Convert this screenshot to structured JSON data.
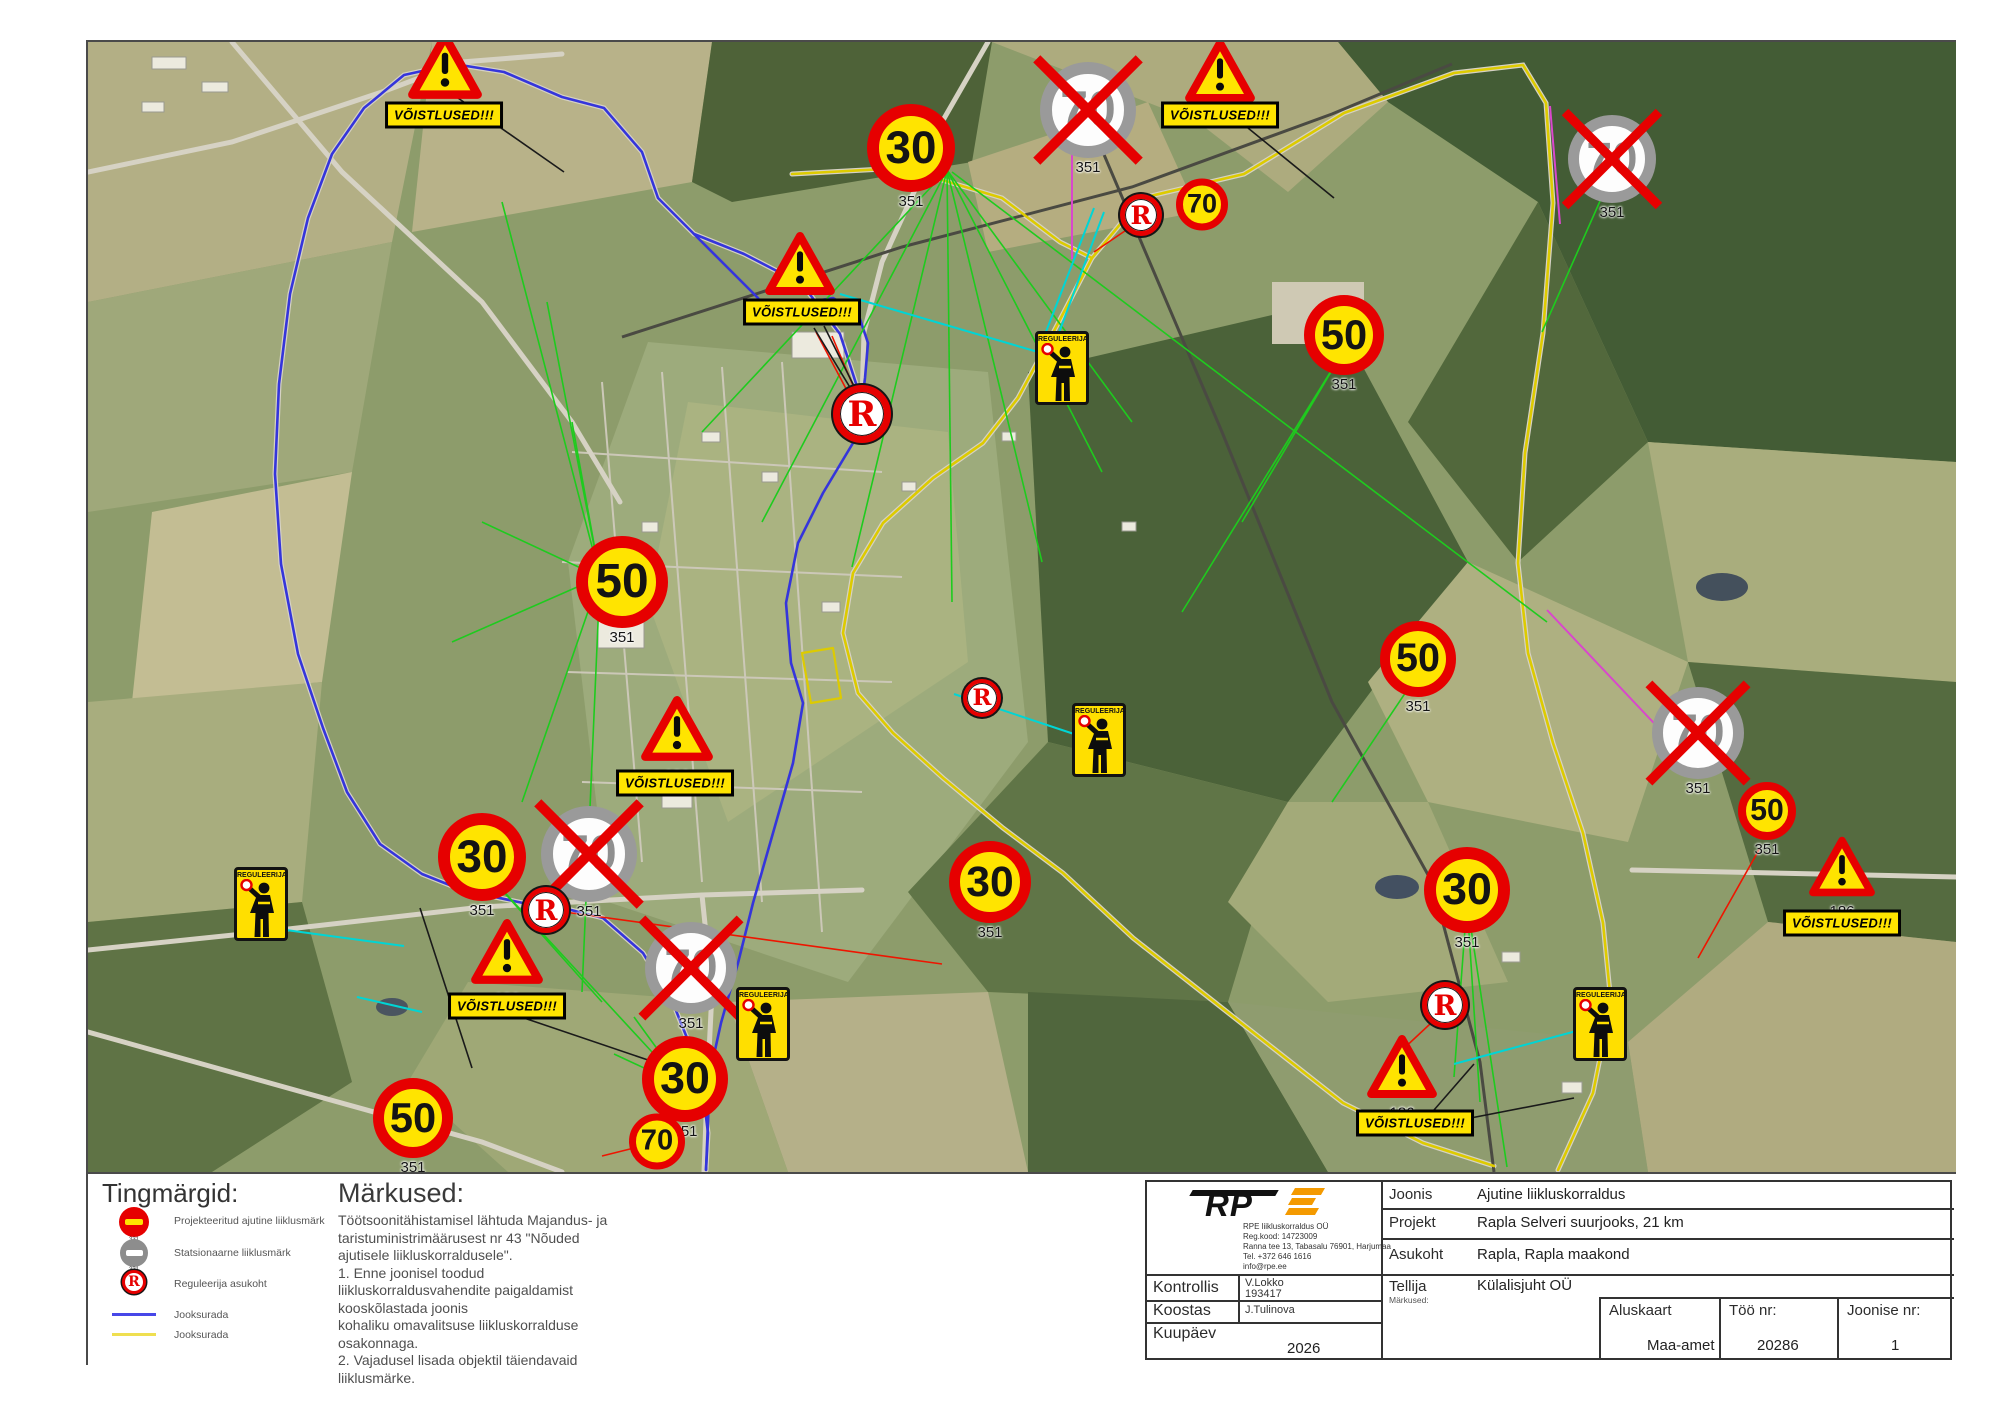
{
  "colors": {
    "sign_red": "#e60000",
    "sign_yellow": "#ffe400",
    "grey_ring": "#9a9a9a",
    "grey_num": "#8f8f8f",
    "route_blue": "#3535db",
    "route_yellow": "#ddcb00",
    "leader_green": "#1ecb1e",
    "leader_cyan": "#00d5d5",
    "leader_red": "#ee1500",
    "leader_magenta": "#d947cc",
    "leader_black": "#1a1a1a"
  },
  "legend": {
    "title": "Tingmärgid:",
    "items": [
      {
        "icon": "temp-sign-icon",
        "code": "331",
        "label": "Projekteeritud ajutine liiklusmärk"
      },
      {
        "icon": "stationary-sign-icon",
        "code": "331",
        "label": "Statsionaarne liiklusmärk"
      },
      {
        "icon": "regulator-point-icon",
        "code": "",
        "label": "Reguleerija asukoht"
      },
      {
        "icon": "line-blue-icon",
        "code": "",
        "label": "Jooksurada"
      },
      {
        "icon": "line-yellow-icon",
        "code": "",
        "label": "Jooksurada"
      }
    ]
  },
  "notes": {
    "title": "Märkused:",
    "lines": [
      "Töötsoonitähistamisel lähtuda Majandus- ja",
      "taristuministrimäärusest nr 43 \"Nõuded",
      "ajutisele liikluskorraldusele\".",
      "1. Enne joonisel toodud",
      "liikluskorraldusvahendite paigaldamist",
      "kooskõlastada joonis",
      "kohaliku omavalitsuse liikluskorralduse",
      "osakonnaga.",
      "2. Vajadusel lisada objektil täiendavaid",
      "liiklusmärke."
    ]
  },
  "title_block": {
    "company": {
      "name": "RPE liikluskorraldus OÜ",
      "reg": "Reg.kood: 14723009",
      "address": "Ranna tee 13, Tabasalu 76901, Harjumaa",
      "tel": "Tel. +372 646 1616",
      "email": "info@rpe.ee",
      "logo_text": "RP"
    },
    "joonis_label": "Joonis",
    "joonis_value": "Ajutine liikluskorraldus",
    "projekt_label": "Projekt",
    "projekt_value": "Rapla Selveri suurjooks, 21 km",
    "asukoht_label": "Asukoht",
    "asukoht_value": "Rapla, Rapla maakond",
    "tellija_label": "Tellija",
    "tellija_value": "Külalisjuht OÜ",
    "markused_label": "Märkused:",
    "kontrollis_label": "Kontrollis",
    "kontrollis_value": "V.Lokko",
    "kontrollis_value2": "193417",
    "koostas_label": "Koostas",
    "koostas_value": "J.Tulinova",
    "kuupaev_label": "Kuupäev",
    "kuupaev_value": "2026",
    "aluskaart_label": "Aluskaart",
    "aluskaart_value": "Maa-amet",
    "too_nr_label": "Töö nr:",
    "too_nr_value": "20286",
    "joonise_nr_label": "Joonise nr:",
    "joonise_nr_value": "1"
  },
  "signs": [
    {
      "type": "speed",
      "value": "30",
      "x": 909,
      "y": 155,
      "size": 88,
      "code": "351"
    },
    {
      "type": "speed",
      "value": "30",
      "x": 480,
      "y": 864,
      "size": 88,
      "code": "351"
    },
    {
      "type": "speed",
      "value": "30",
      "x": 683,
      "y": 1086,
      "size": 86,
      "code": "351"
    },
    {
      "type": "speed",
      "value": "30",
      "x": 988,
      "y": 889,
      "size": 82,
      "code": "351"
    },
    {
      "type": "speed",
      "value": "30",
      "x": 1465,
      "y": 897,
      "size": 86,
      "code": "351"
    },
    {
      "type": "speed",
      "value": "50",
      "x": 620,
      "y": 589,
      "size": 92,
      "code": "351"
    },
    {
      "type": "speed",
      "value": "50",
      "x": 1342,
      "y": 342,
      "size": 80,
      "code": "351"
    },
    {
      "type": "speed",
      "value": "50",
      "x": 1416,
      "y": 666,
      "size": 76,
      "code": "351"
    },
    {
      "type": "speed",
      "value": "50",
      "x": 411,
      "y": 1125,
      "size": 80,
      "code": "351"
    },
    {
      "type": "speed",
      "value": "50",
      "x": 1765,
      "y": 818,
      "size": 58,
      "code": "351"
    },
    {
      "type": "speed",
      "value": "70",
      "x": 1200,
      "y": 203,
      "size": 52,
      "code": ""
    },
    {
      "type": "speed",
      "value": "70",
      "x": 655,
      "y": 1140,
      "size": 56,
      "code": ""
    },
    {
      "type": "crossed",
      "value": "70",
      "x": 1086,
      "y": 117,
      "size": 96,
      "code": "351"
    },
    {
      "type": "crossed",
      "value": "70",
      "x": 1610,
      "y": 166,
      "size": 88,
      "code": "351"
    },
    {
      "type": "crossed",
      "value": "70",
      "x": 587,
      "y": 861,
      "size": 96,
      "code": "351"
    },
    {
      "type": "crossed",
      "value": "70",
      "x": 689,
      "y": 975,
      "size": 92,
      "code": "351"
    },
    {
      "type": "crossed",
      "value": "70",
      "x": 1696,
      "y": 740,
      "size": 92,
      "code": "351"
    },
    {
      "type": "warning",
      "x": 443,
      "y": 75,
      "w": 74,
      "code": "186"
    },
    {
      "type": "warning",
      "x": 1218,
      "y": 80,
      "w": 70,
      "code": "186"
    },
    {
      "type": "warning",
      "x": 798,
      "y": 273,
      "w": 70,
      "code": "186"
    },
    {
      "type": "warning",
      "x": 675,
      "y": 738,
      "w": 72,
      "code": "186"
    },
    {
      "type": "warning",
      "x": 505,
      "y": 961,
      "w": 72,
      "code": "186"
    },
    {
      "type": "warning",
      "x": 1840,
      "y": 876,
      "w": 66,
      "code": "186"
    },
    {
      "type": "warning",
      "x": 1400,
      "y": 1076,
      "w": 70,
      "code": "186"
    },
    {
      "type": "banner",
      "text": "VÕISTLUSED!!!",
      "x": 442,
      "y": 113
    },
    {
      "type": "banner",
      "text": "VÕISTLUSED!!!",
      "x": 1218,
      "y": 113
    },
    {
      "type": "banner",
      "text": "VÕISTLUSED!!!",
      "x": 800,
      "y": 310
    },
    {
      "type": "banner",
      "text": "VÕISTLUSED!!!",
      "x": 673,
      "y": 781
    },
    {
      "type": "banner",
      "text": "VÕISTLUSED!!!",
      "x": 505,
      "y": 1004
    },
    {
      "type": "banner",
      "text": "VÕISTLUSED!!!",
      "x": 1840,
      "y": 921
    },
    {
      "type": "banner",
      "text": "VÕISTLUSED!!!",
      "x": 1413,
      "y": 1121
    },
    {
      "type": "regulator",
      "text": "REGULEERIJA",
      "x": 1060,
      "y": 366
    },
    {
      "type": "regulator",
      "text": "REGULEERIJA",
      "x": 1097,
      "y": 738
    },
    {
      "type": "regulator",
      "text": "REGULEERIJA",
      "x": 259,
      "y": 902
    },
    {
      "type": "regulator",
      "text": "REGULEERIJA",
      "x": 761,
      "y": 1022
    },
    {
      "type": "regulator",
      "text": "REGULEERIJA",
      "x": 1598,
      "y": 1022
    },
    {
      "type": "rpoint",
      "text": "R",
      "x": 1139,
      "y": 213,
      "size": 42
    },
    {
      "type": "rpoint",
      "text": "R",
      "x": 860,
      "y": 412,
      "size": 58
    },
    {
      "type": "rpoint",
      "text": "R",
      "x": 980,
      "y": 696,
      "size": 38
    },
    {
      "type": "rpoint",
      "text": "R",
      "x": 544,
      "y": 908,
      "size": 46
    },
    {
      "type": "rpoint",
      "text": "R",
      "x": 1443,
      "y": 1003,
      "size": 46
    }
  ],
  "routes": [
    {
      "name": "jooksurada-blue-loop",
      "color": "#3535db",
      "width": 2.6,
      "points": "860,400 838,332 800,282 742,252 692,232 656,196 640,150 602,106 560,95 502,70 452,62 402,73 362,106 330,152 306,216 288,292 277,382 273,472 279,562 296,652 321,726 345,790 378,842 420,872 460,888 521,901 561,906 601,916 641,951 671,1001 691,1051 701,1091 706,1131 704,1168"
    },
    {
      "name": "jooksurada-blue-inner",
      "color": "#3535db",
      "width": 2.6,
      "points": "860,400 851,441 821,491 796,541 784,601 789,661 801,701 791,761 771,831 751,901 736,961 719,1021 708,1071 704,1168"
    },
    {
      "name": "jooksurada-blue-selver",
      "color": "#3535db",
      "width": 2.6,
      "points": "692,232 722,262 756,296 771,321 801,301 831,296 856,311 866,341 863,376 860,400"
    },
    {
      "name": "jooksurada-yellow-north",
      "color": "#ddcb00",
      "width": 2.6,
      "points": "790,172 900,166 1000,196 1058,240 1090,256 1140,196 1242,172 1342,111 1452,71 1521,63 1544,101 1551,201 1541,331 1523,451 1516,561 1526,651 1551,741 1581,831 1601,921 1609,1001 1591,1091 1556,1168"
    },
    {
      "name": "jooksurada-yellow-town",
      "color": "#ddcb00",
      "width": 2.6,
      "points": "1090,256 1051,331 1016,396 981,441 931,476 881,521 851,571 841,631 856,691 891,731 941,776 1001,826 1061,871 1131,936 1201,991 1271,1046 1341,1101 1421,1141 1492,1164"
    },
    {
      "name": "jooksurada-yellow-area",
      "color": "#ddcb00",
      "width": 2.2,
      "points": "800,651 831,646 839,696 809,701 800,651"
    }
  ],
  "leader_lines": [
    {
      "color": "#1ecb1e",
      "width": 1.6,
      "segments": [
        [
          945,
          168,
          700,
          430
        ],
        [
          945,
          168,
          760,
          520
        ],
        [
          945,
          168,
          850,
          565
        ],
        [
          945,
          168,
          950,
          600
        ],
        [
          945,
          168,
          1040,
          560
        ],
        [
          945,
          168,
          1100,
          470
        ],
        [
          945,
          168,
          1130,
          420
        ],
        [
          950,
          170,
          1545,
          620
        ],
        [
          598,
          575,
          500,
          200
        ],
        [
          598,
          575,
          545,
          300
        ],
        [
          598,
          575,
          570,
          420
        ],
        [
          598,
          575,
          480,
          520
        ],
        [
          598,
          575,
          450,
          640
        ],
        [
          598,
          575,
          520,
          800
        ],
        [
          598,
          575,
          580,
          990
        ],
        [
          482,
          868,
          600,
          1000
        ],
        [
          482,
          868,
          650,
          1050
        ],
        [
          683,
          1085,
          612,
          1052
        ],
        [
          683,
          1085,
          632,
          1015
        ],
        [
          1465,
          900,
          1452,
          1075
        ],
        [
          1465,
          900,
          1478,
          1100
        ],
        [
          1465,
          900,
          1505,
          1165
        ],
        [
          1342,
          348,
          1240,
          520
        ],
        [
          1342,
          348,
          1180,
          610
        ],
        [
          1610,
          172,
          1540,
          330
        ],
        [
          1416,
          672,
          1330,
          800
        ]
      ]
    },
    {
      "color": "#00d5d5",
      "width": 2,
      "segments": [
        [
          1092,
          206,
          1040,
          340
        ],
        [
          1102,
          210,
          1052,
          344
        ],
        [
          838,
          292,
          1036,
          350
        ],
        [
          952,
          692,
          1072,
          732
        ],
        [
          1452,
          1062,
          1578,
          1028
        ],
        [
          284,
          928,
          402,
          944
        ],
        [
          355,
          995,
          420,
          1010
        ]
      ]
    },
    {
      "color": "#ee1500",
      "width": 1.6,
      "segments": [
        [
          1139,
          218,
          1092,
          250
        ],
        [
          850,
          398,
          814,
          330
        ],
        [
          858,
          400,
          830,
          334
        ],
        [
          548,
          908,
          940,
          962
        ],
        [
          600,
          1154,
          632,
          1146
        ],
        [
          1443,
          1008,
          1398,
          1050
        ],
        [
          1758,
          846,
          1696,
          956
        ]
      ]
    },
    {
      "color": "#d947cc",
      "width": 2,
      "segments": [
        [
          1070,
          143,
          1070,
          257
        ],
        [
          1545,
          608,
          1666,
          736
        ],
        [
          1548,
          104,
          1558,
          222
        ]
      ]
    },
    {
      "color": "#1a1a1a",
      "width": 1.6,
      "segments": [
        [
          456,
          96,
          562,
          170
        ],
        [
          1246,
          126,
          1332,
          196
        ],
        [
          812,
          326,
          852,
          392
        ],
        [
          822,
          324,
          858,
          396
        ],
        [
          1448,
          1120,
          1572,
          1096
        ],
        [
          1432,
          1108,
          1472,
          1062
        ],
        [
          522,
          1016,
          646,
          1058
        ],
        [
          418,
          906,
          470,
          1066
        ]
      ]
    }
  ]
}
